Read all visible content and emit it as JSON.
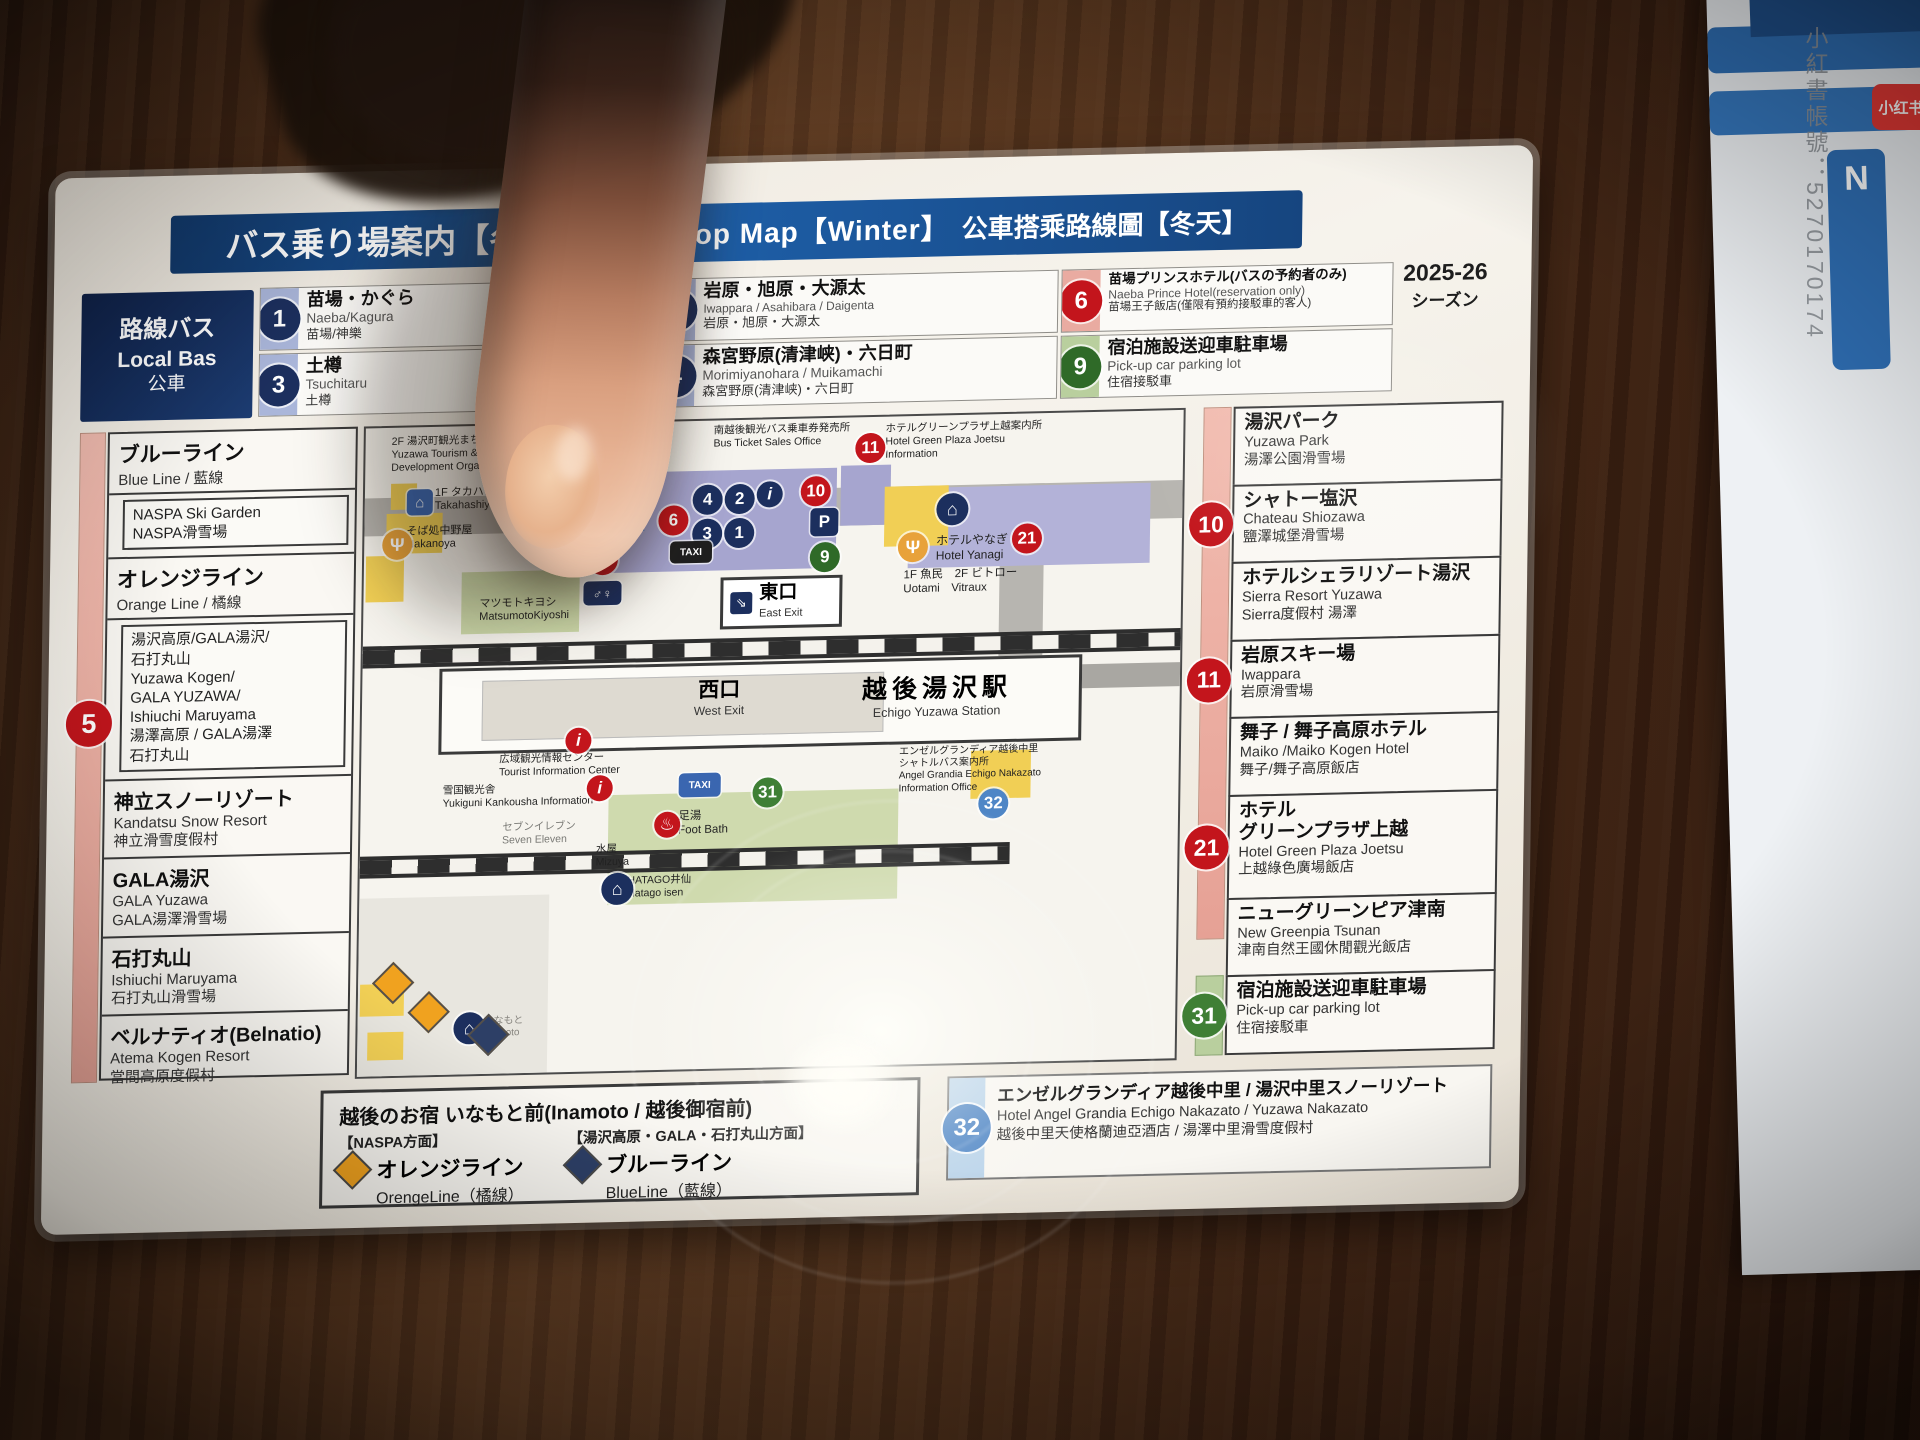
{
  "watermark": {
    "account": "小紅書帳號：5270170174",
    "app": "小红书",
    "side_letter": "N"
  },
  "card": {
    "title": {
      "ja": "バス乗り場案内【冬期】",
      "en": "Bus Stop Map【Winter】",
      "zh": "公車搭乘路線圖【冬天】"
    },
    "season": {
      "line1": "2025-26",
      "line2": "シーズン"
    },
    "local_bus": {
      "ja": "路線バス",
      "en": "Local Bas",
      "zh": "公車"
    },
    "stops_top": [
      {
        "num": "1",
        "band": "#aab6da",
        "circle": "#1c2f5e",
        "ja": "苗場・かぐら",
        "en": "Naeba/Kagura",
        "zh": "苗場/神樂"
      },
      {
        "num": "2",
        "band": "#aab6da",
        "circle": "#1c2f5e",
        "ja": "岩原・旭原・大源太",
        "en": "Iwappara / Asahibara / Daigenta",
        "zh": "岩原・旭原・大源太"
      },
      {
        "num": "6",
        "band": "#e9aba1",
        "circle": "#c3151c",
        "ja": "苗場プリンスホテル(バスの予約者のみ)",
        "en": "Naeba Prince Hotel(reservation only)",
        "zh": "苗場王子飯店(僅限有預約接駁車的客人)"
      },
      {
        "num": "3",
        "band": "#aab6da",
        "circle": "#1c2f5e",
        "ja": "土樽",
        "en": "Tsuchitaru",
        "zh": "土樽"
      },
      {
        "num": "4",
        "band": "#aab6da",
        "circle": "#1c2f5e",
        "ja": "森宮野原(清津峡)・六日町",
        "en": "Morimiyanohara / Muikamachi",
        "zh": "森宮野原(清津峡)・六日町"
      },
      {
        "num": "9",
        "band": "#b9cf9e",
        "circle": "#2f6a28",
        "ja": "宿泊施設送迎車駐車場",
        "en": "Pick-up car parking lot",
        "zh": "住宿接駁車"
      }
    ],
    "left_sidebar": {
      "badge": "5",
      "sections": [
        {
          "kind": "header",
          "ja": "ブルーライン",
          "sub": "Blue Line / 藍線"
        },
        {
          "kind": "box",
          "lines": "NASPA Ski Garden\nNASPA滑雪場"
        },
        {
          "kind": "header",
          "ja": "オレンジライン",
          "sub": "Orange Line / 橘線"
        },
        {
          "kind": "box",
          "lines": "湯沢高原/GALA湯沢/\n石打丸山\nYuzawa Kogen/\nGALA YUZAWA/\nIshiuchi Maruyama\n湯澤高原 / GALA湯澤\n石打丸山"
        },
        {
          "kind": "entry",
          "ja": "神立スノーリゾート",
          "lines": "Kandatsu Snow Resort\n神立滑雪度假村"
        },
        {
          "kind": "entry",
          "ja": "GALA湯沢",
          "lines": "GALA Yuzawa\nGALA湯澤滑雪場"
        },
        {
          "kind": "entry",
          "ja": "石打丸山",
          "lines": "Ishiuchi Maruyama\n石打丸山滑雪場"
        },
        {
          "kind": "entry",
          "ja": "ベルナティオ(Belnatio)",
          "lines": "Atema Kogen Resort\n當間高原度假村"
        }
      ]
    },
    "right_sidebar": {
      "entries": [
        {
          "ja": "湯沢パーク",
          "lines": "Yuzawa Park\n湯澤公園滑雪場",
          "grow": 3
        },
        {
          "badge": "10",
          "ja": "シャトー塩沢",
          "lines": "Chateau Shiozawa\n鹽澤城堡滑雪場",
          "grow": 3
        },
        {
          "ja": "ホテルシェラリゾート湯沢",
          "lines": "Sierra Resort Yuzawa\nSierra度假村 湯澤",
          "grow": 3
        },
        {
          "badge": "11",
          "ja": "岩原スキー場",
          "lines": "Iwappara\n岩原滑雪場",
          "grow": 3
        },
        {
          "ja": "舞子 / 舞子高原ホテル",
          "lines": "Maiko /Maiko Kogen Hotel\n舞子/舞子高原飯店",
          "grow": 3
        },
        {
          "badge": "21",
          "ja": "ホテル\nグリーンプラザ上越",
          "lines": "Hotel Green Plaza Joetsu\n上越綠色廣場飯店",
          "grow": 4
        },
        {
          "ja": "ニューグリーンピア津南",
          "lines": "New Greenpia Tsunan\n津南自然王國休閒觀光飯店",
          "grow": 3
        },
        {
          "badge": "31",
          "green": true,
          "ja": "宿泊施設送迎車駐車場",
          "lines": "Pick-up car parking lot\n住宿接駁車",
          "grow": 3
        }
      ]
    },
    "bottom_legend": {
      "title": "越後のお宿 いなもと前(Inamoto / 越後御宿前)",
      "naspa_dir": "【NASPA方面】",
      "orange_name": "オレンジライン",
      "orange_en": "OrengeLine（橘線）",
      "yuzawa_dir": "【湯沢高原・GALA・石打丸山方面】",
      "blue_name": "ブルーライン",
      "blue_en": "BlueLine（藍線）"
    },
    "stop32": {
      "num": "32",
      "l1": "エンゼルグランディア越後中里 / 湯沢中里スノーリゾート",
      "l2": "Hotel Angel Grandia Echigo Nakazato / Yuzawa Nakazato",
      "l3": "越後中里天使格蘭迪亞酒店 / 湯澤中里滑雪度假村"
    },
    "map": {
      "east_exit": {
        "ja": "東口",
        "en": "East Exit"
      },
      "west_exit": {
        "ja": "西口",
        "en": "West Exit"
      },
      "station": {
        "ja": "越後湯沢駅",
        "en": "Echigo Yuzawa Station"
      },
      "labels": [
        {
          "x": 26,
          "y": 8,
          "s": 10.5,
          "text": "2F 湯沢町観光まちづくり機構\nYuzawa Tourism & Community\nDevelopment Organizations"
        },
        {
          "x": 70,
          "y": 60,
          "s": 11,
          "text": "1F タカハシヤ\nTakahashiya"
        },
        {
          "x": 42,
          "y": 98,
          "s": 11,
          "text": "そば処中野屋\nNakanoya"
        },
        {
          "x": 348,
          "y": 4,
          "s": 10.5,
          "text": "南越後観光バス乗車券発売所\nBus Ticket Sales Office"
        },
        {
          "x": 520,
          "y": 6,
          "s": 10.5,
          "text": "ホテルグリーンプラザ上越案内所\nHotel Green Plaza Joetsu\nInformation"
        },
        {
          "x": 116,
          "y": 172,
          "s": 11,
          "text": "マツモトキヨシ\nMatsumotoKiyoshi"
        },
        {
          "x": 572,
          "y": 118,
          "s": 12,
          "text": "ホテルやなぎ\nHotel Yanagi"
        },
        {
          "x": 540,
          "y": 152,
          "s": 11.5,
          "text": "1F 魚民　2F ビトロー\nUotami　Vitraux"
        },
        {
          "x": 138,
          "y": 328,
          "s": 10.5,
          "text": "広域観光情報センター\nTourist Information Center"
        },
        {
          "x": 82,
          "y": 358,
          "s": 10.5,
          "text": "雪国観光舎\nYukiguni Kankousha Information"
        },
        {
          "x": 538,
          "y": 330,
          "s": 10,
          "text": "エンゼルグランディア越後中里\nシャトルバス案内所\nAngel Grandia Echigo Nakazato\nInformation Office"
        },
        {
          "x": 142,
          "y": 396,
          "s": 10.5,
          "c": "#7a7a76",
          "text": "セブンイレブン\nSeven Eleven"
        },
        {
          "x": 318,
          "y": 388,
          "s": 11.5,
          "text": "足湯\nFoot Bath"
        },
        {
          "x": 236,
          "y": 420,
          "s": 10.5,
          "text": "水屋\nMizuya"
        },
        {
          "x": 268,
          "y": 452,
          "s": 10.5,
          "text": "HATAGO井仙\nHatago isen"
        },
        {
          "x": 126,
          "y": 590,
          "s": 10,
          "c": "#87857f",
          "text": "いなもと\nInamoto"
        }
      ],
      "badges": [
        {
          "t": "star",
          "x": 258,
          "y": 84
        },
        {
          "t": "c",
          "x": 294,
          "y": 84,
          "col": "#c3151c",
          "txt": "6"
        },
        {
          "t": "c",
          "x": 328,
          "y": 64,
          "col": "#1c2f5e",
          "txt": "4"
        },
        {
          "t": "c",
          "x": 360,
          "y": 64,
          "col": "#1c2f5e",
          "txt": "2"
        },
        {
          "t": "ni",
          "x": 392,
          "y": 62
        },
        {
          "t": "c",
          "x": 436,
          "y": 58,
          "col": "#c3151c",
          "txt": "10"
        },
        {
          "t": "c",
          "x": 328,
          "y": 98,
          "col": "#1c2f5e",
          "txt": "3"
        },
        {
          "t": "c",
          "x": 360,
          "y": 98,
          "col": "#1c2f5e",
          "txt": "1"
        },
        {
          "t": "sq",
          "x": 446,
          "y": 90,
          "col": "#1c2f5e",
          "txt": "P"
        },
        {
          "t": "taxi",
          "x": 306,
          "y": 120
        },
        {
          "t": "c",
          "x": 446,
          "y": 124,
          "col": "#2f6a28",
          "txt": "9"
        },
        {
          "t": "c",
          "x": 224,
          "y": 122,
          "col": "#c3151c",
          "txt": "5"
        },
        {
          "t": "c",
          "x": 490,
          "y": 16,
          "col": "#c3151c",
          "txt": "11"
        },
        {
          "t": "c",
          "x": 648,
          "y": 110,
          "col": "#c3151c",
          "txt": "21"
        },
        {
          "t": "hotel",
          "x": 572,
          "y": 78
        },
        {
          "t": "fork",
          "x": 534,
          "y": 116
        },
        {
          "t": "fork",
          "x": 18,
          "y": 102
        },
        {
          "t": "shop",
          "x": 42,
          "y": 62
        },
        {
          "t": "i",
          "x": 178,
          "y": 50
        },
        {
          "t": "i",
          "x": 204,
          "y": 304
        },
        {
          "t": "i",
          "x": 226,
          "y": 352
        },
        {
          "t": "wc",
          "x": 220,
          "y": 158
        },
        {
          "t": "onsen",
          "x": 294,
          "y": 390
        },
        {
          "t": "taxib",
          "x": 318,
          "y": 352
        },
        {
          "t": "c",
          "x": 392,
          "y": 358,
          "col": "#3f7f35",
          "txt": "31"
        },
        {
          "t": "c",
          "x": 618,
          "y": 374,
          "col": "#4f86c6",
          "txt": "32"
        },
        {
          "t": "hotel",
          "x": 242,
          "y": 450
        },
        {
          "t": "hotel",
          "x": 96,
          "y": 586
        },
        {
          "t": "d",
          "x": 56,
          "y": 570,
          "col": "#f0a21f"
        },
        {
          "t": "d",
          "x": 116,
          "y": 594,
          "col": "#2d3f66"
        },
        {
          "t": "d",
          "x": 20,
          "y": 540,
          "col": "#f0a21f"
        }
      ]
    }
  }
}
